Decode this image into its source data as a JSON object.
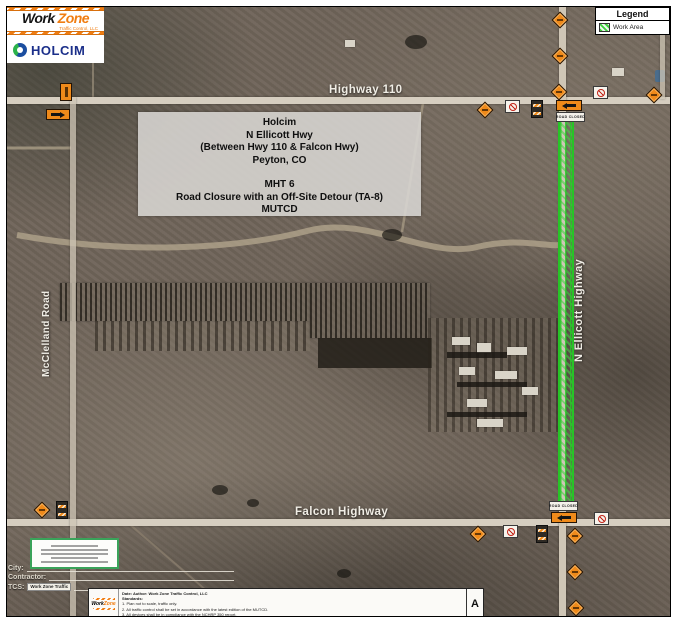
{
  "branding": {
    "workzone_word1": "Work",
    "workzone_word2": "Zone",
    "workzone_sub": "Traffic Control, LLC",
    "holcim_label": "HOLCIM"
  },
  "legend": {
    "title": "Legend",
    "work_area_label": "Work Area",
    "work_area_color": "#3ecf3e"
  },
  "info_box": {
    "line1": "Holcim",
    "line2": "N Ellicott Hwy",
    "line3": "(Between Hwy 110 & Falcon Hwy)",
    "line4": "Peyton, CO",
    "line5": "MHT 6",
    "line6": "Road Closure with an Off-Site Detour (TA-8)",
    "line7": "MUTCD"
  },
  "road_labels": {
    "top": "Highway 110",
    "bottom": "Falcon Highway",
    "right_vertical": "N Ellicott Highway",
    "left_vertical": "McClelland Road"
  },
  "signs": {
    "road_closed": "ROAD CLOSED"
  },
  "title_block": {
    "city_label": "City:",
    "contractor_label": "Contractor:",
    "tcs_label": "TCS:",
    "tcs_value": "Work Zone Traffic",
    "notes": {
      "date_author": "Date:            Author: Work Zone Traffic Control, LLC",
      "standards_label": "Standards:",
      "note1": "1. Plan not to scale, traffic only.",
      "note2": "2. All traffic control shall be set in accordance with the latest edition of the MUTCD.",
      "note3": "3. All devices shall be in compliance with the NCHRP 350 report.",
      "revision": "A"
    }
  },
  "colors": {
    "work_area_green": "#2fd02f",
    "sign_orange": "#ef8a1a"
  }
}
